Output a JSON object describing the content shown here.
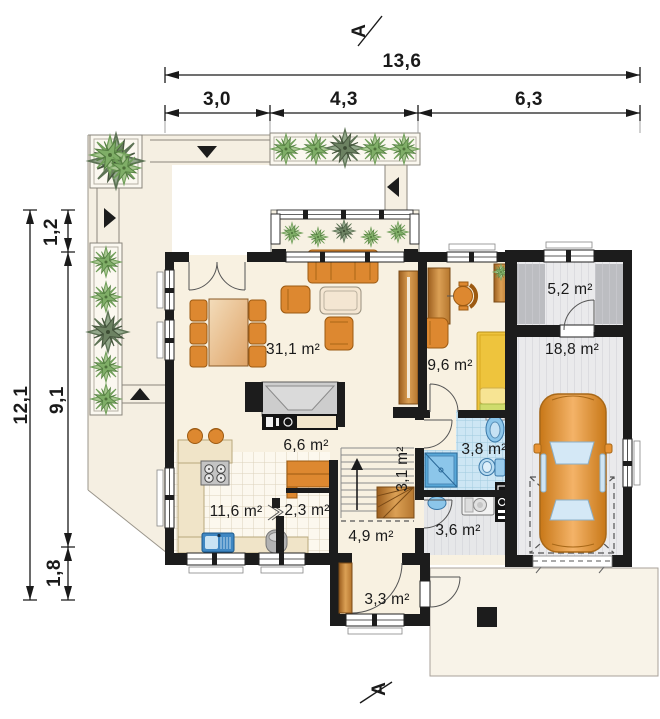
{
  "plan": {
    "section_marker_top": "A",
    "section_marker_bottom": "A",
    "dimensions_top": {
      "total": "13,6",
      "seg1": "3,0",
      "seg2": "4,3",
      "seg3": "6,3"
    },
    "dimensions_left": {
      "total": "12,1",
      "seg1": "1,2",
      "seg2": "9,1",
      "seg3": "1,8"
    },
    "rooms": [
      {
        "id": "living-dining",
        "area": "31,1 m²"
      },
      {
        "id": "study",
        "area": "9,6 m²"
      },
      {
        "id": "storage",
        "area": "5,2 m²"
      },
      {
        "id": "garage",
        "area": "18,8 m²"
      },
      {
        "id": "hall",
        "area": "6,6 m²"
      },
      {
        "id": "bathroom",
        "area": "3,8 m²"
      },
      {
        "id": "kitchen",
        "area": "11,6 m²"
      },
      {
        "id": "pantry",
        "area": "2,3 m²"
      },
      {
        "id": "stairs",
        "area": "3,1 m²"
      },
      {
        "id": "corridor",
        "area": "4,9 m²"
      },
      {
        "id": "utility",
        "area": "3,6 m²"
      },
      {
        "id": "vestibule",
        "area": "3,3 m²"
      }
    ],
    "colors": {
      "wall": "#1c1c1c",
      "floor_cream": "#f8f1e1",
      "terrace": "#f5efe2",
      "furniture_orange": "#dd8830",
      "wood": "#c08844",
      "bed_yellow": "#eec43d",
      "tile_blue": "#cde6f4",
      "fixture_blue": "#7fc0e6",
      "floor_gray": "#eaeaec",
      "plant_green": "#7fae67",
      "car_orange": "#e89334"
    }
  }
}
